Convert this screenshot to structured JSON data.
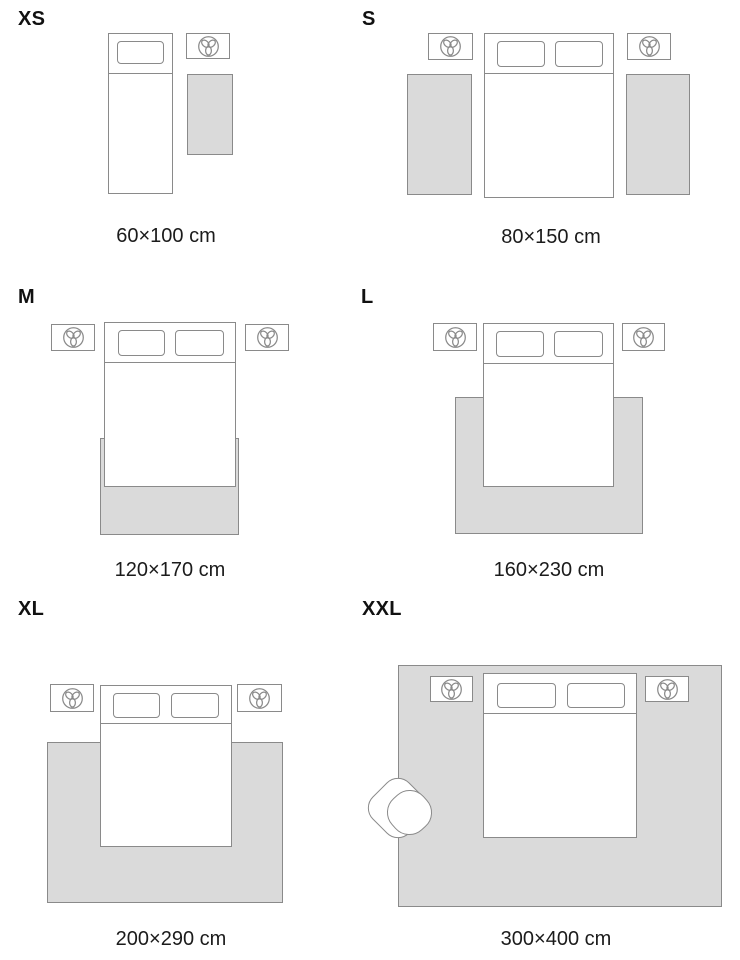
{
  "page": {
    "title": "Rug size guide"
  },
  "colors": {
    "background": "#ffffff",
    "outline": "#8a8a8a",
    "rug_fill": "#dadada",
    "text": "#1b1b1b"
  },
  "icons": {
    "nightstand_decor": "plant-top-view-icon"
  },
  "sizes": [
    {
      "label": "XS",
      "dimensions": "60×100 cm"
    },
    {
      "label": "S",
      "dimensions": "80×150 cm"
    },
    {
      "label": "M",
      "dimensions": "120×170 cm"
    },
    {
      "label": "L",
      "dimensions": "160×230 cm"
    },
    {
      "label": "XL",
      "dimensions": "200×290 cm"
    },
    {
      "label": "XXL",
      "dimensions": "300×400 cm"
    }
  ]
}
